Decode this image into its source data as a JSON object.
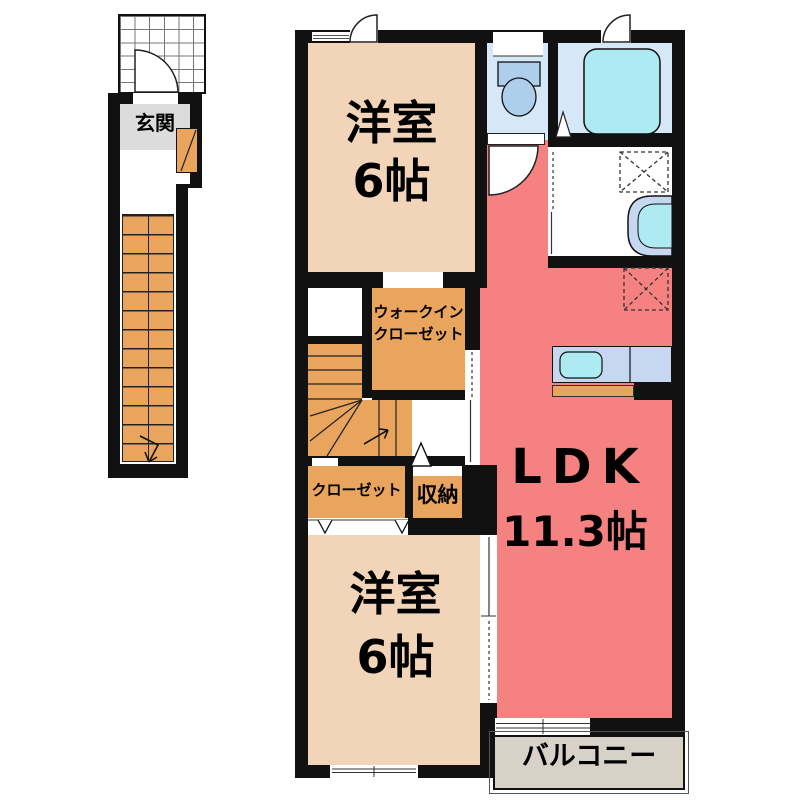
{
  "labels": {
    "genkan": "玄関",
    "bedroom_top_name": "洋室",
    "bedroom_top_area": "6帖",
    "wic_line1": "ウォークイン",
    "wic_line2": "クローゼット",
    "closet": "クローゼット",
    "storage": "収納",
    "bedroom_bottom_name": "洋室",
    "bedroom_bottom_area": "6帖",
    "ldk_name": "LDK",
    "ldk_area": "11.3帖",
    "balcony": "バルコニー"
  },
  "colors": {
    "wall": "#111111",
    "bedroom": "#f2d4b8",
    "ldk": "#f58181",
    "stairs_orange": "#e9a55e",
    "wet_room_blue": "#d6e8f7",
    "fixture_blue": "#aecfec",
    "tub_cyan": "#aeeaf2",
    "counter_blue": "#c5d8f0",
    "balcony_gray": "#d7d1c7",
    "genkan_gray": "#dcdcdc"
  }
}
